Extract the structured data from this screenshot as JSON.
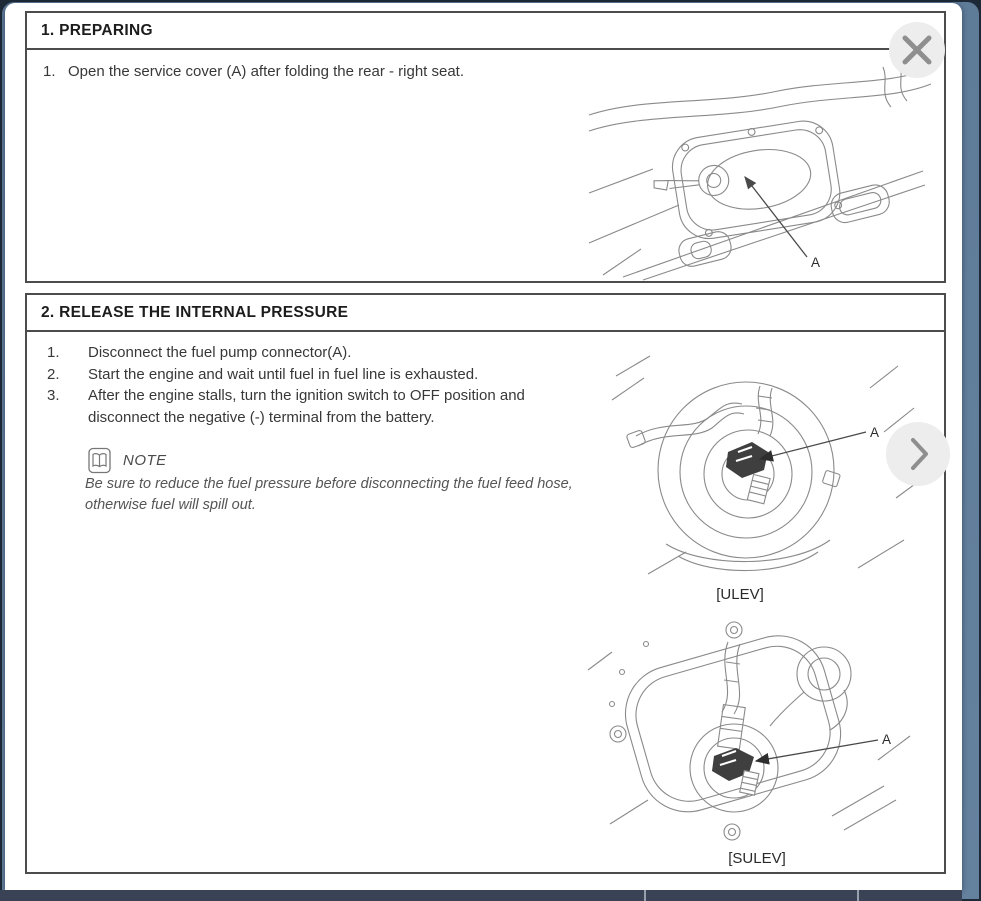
{
  "colors": {
    "backdrop": "#5E7B98",
    "frame": "#1E2938",
    "footer_bar": "#3A4356",
    "page": "#FFFFFF",
    "button_bg": "#EDEDEE",
    "icon_gray": "#8F8F8F"
  },
  "viewer": {
    "close_button": {
      "icon": "close-x"
    },
    "next_button": {
      "icon": "chevron-right"
    }
  },
  "document": {
    "sections": [
      {
        "title": "1. PREPARING",
        "steps": [
          {
            "num": "1.",
            "text": "Open the service cover (A) after folding the rear - right seat."
          }
        ],
        "figure": {
          "callout": "A"
        }
      },
      {
        "title": "2. RELEASE THE INTERNAL PRESSURE",
        "steps": [
          {
            "num": "1.",
            "text": "Disconnect the fuel pump connector(A)."
          },
          {
            "num": "2.",
            "text": "Start the engine and wait until fuel in fuel line is exhausted."
          },
          {
            "num": "3.",
            "text": "After the engine stalls, turn the ignition switch to OFF position and disconnect the negative (-) terminal from the battery."
          }
        ],
        "note": {
          "label": "NOTE",
          "icon": "open-book",
          "text": "Be sure to reduce the fuel pressure before disconnecting the fuel feed hose, otherwise fuel will spill out."
        },
        "figures": [
          {
            "caption": "[ULEV]",
            "callout": "A"
          },
          {
            "caption": "[SULEV]",
            "callout": "A"
          }
        ]
      }
    ]
  }
}
